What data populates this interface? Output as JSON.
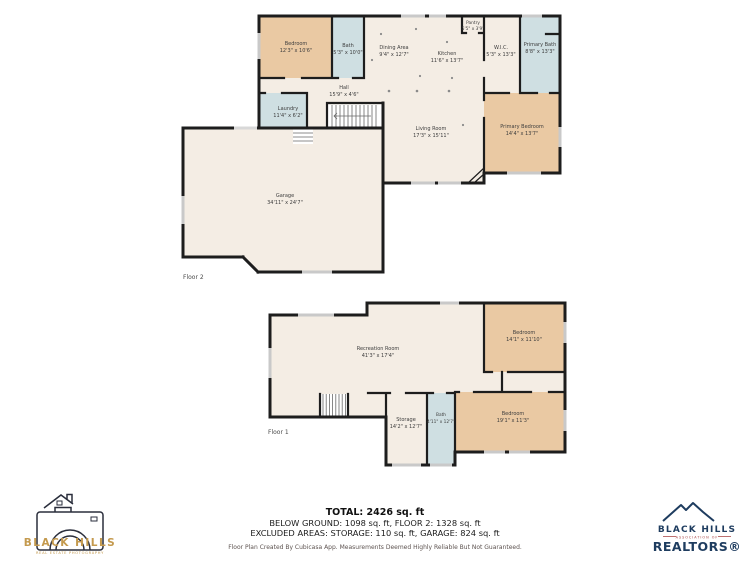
{
  "floor2": {
    "caption": "Floor 2",
    "rooms": [
      {
        "name": "Bedroom",
        "dims": "12'3\" x 10'6\""
      },
      {
        "name": "Bath",
        "dims": "5'3\" x 10'0\""
      },
      {
        "name": "Dining Area",
        "dims": "9'4\" x 12'7\""
      },
      {
        "name": "Kitchen",
        "dims": "11'6\" x 13'7\""
      },
      {
        "name": "Pantry",
        "dims": "5'5\" x 3'9\""
      },
      {
        "name": "W.I.C.",
        "dims": "5'3\" x 13'3\""
      },
      {
        "name": "Primary Bath",
        "dims": "8'8\" x 13'3\""
      },
      {
        "name": "Primary Bedroom",
        "dims": "14'4\" x 13'7\""
      },
      {
        "name": "Living Room",
        "dims": "17'3\" x 15'11\""
      },
      {
        "name": "Hall",
        "dims": "15'9\" x 4'6\""
      },
      {
        "name": "Laundry",
        "dims": "11'4\" x 6'2\""
      },
      {
        "name": "Garage",
        "dims": "34'11\" x 24'7\""
      }
    ]
  },
  "floor1": {
    "caption": "Floor 1",
    "rooms": [
      {
        "name": "Recreation Room",
        "dims": "41'3\" x 17'4\""
      },
      {
        "name": "Bedroom",
        "dims": "14'1\" x 11'10\""
      },
      {
        "name": "Storage",
        "dims": "14'2\" x 12'7\""
      },
      {
        "name": "Bath",
        "dims": "4'11\" x 12'7\""
      },
      {
        "name": "Bedroom",
        "dims": "19'1\" x 11'3\""
      }
    ]
  },
  "summary": {
    "total": "TOTAL: 2426 sq. ft",
    "line2": "BELOW GROUND: 1098 sq. ft, FLOOR 2: 1328 sq. ft",
    "line3": "EXCLUDED AREAS: STORAGE: 110 sq. ft, GARAGE: 824 sq. ft",
    "disclaimer": "Floor Plan Created By Cubicasa App. Measurements Deemed Highly Reliable But Not Guaranteed."
  },
  "logos": {
    "photography": {
      "title": "BLACK HILLS",
      "subtitle": "REAL ESTATE PHOTOGRAPHY"
    },
    "realtors": {
      "title": "BLACK HILLS",
      "association": "ASSOCIATION OF",
      "name": "REALTORS®"
    }
  },
  "colors": {
    "wall": "#1d1d1d",
    "room_cream": "#f4ede4",
    "room_tan": "#eac9a3",
    "room_blue": "#cfdfe2",
    "stairs_white": "#ffffff",
    "window": "#c9c9c9",
    "logo_gold": "#c49a4e",
    "logo_navy": "#1e3c5f",
    "logo_red": "#a84040"
  }
}
